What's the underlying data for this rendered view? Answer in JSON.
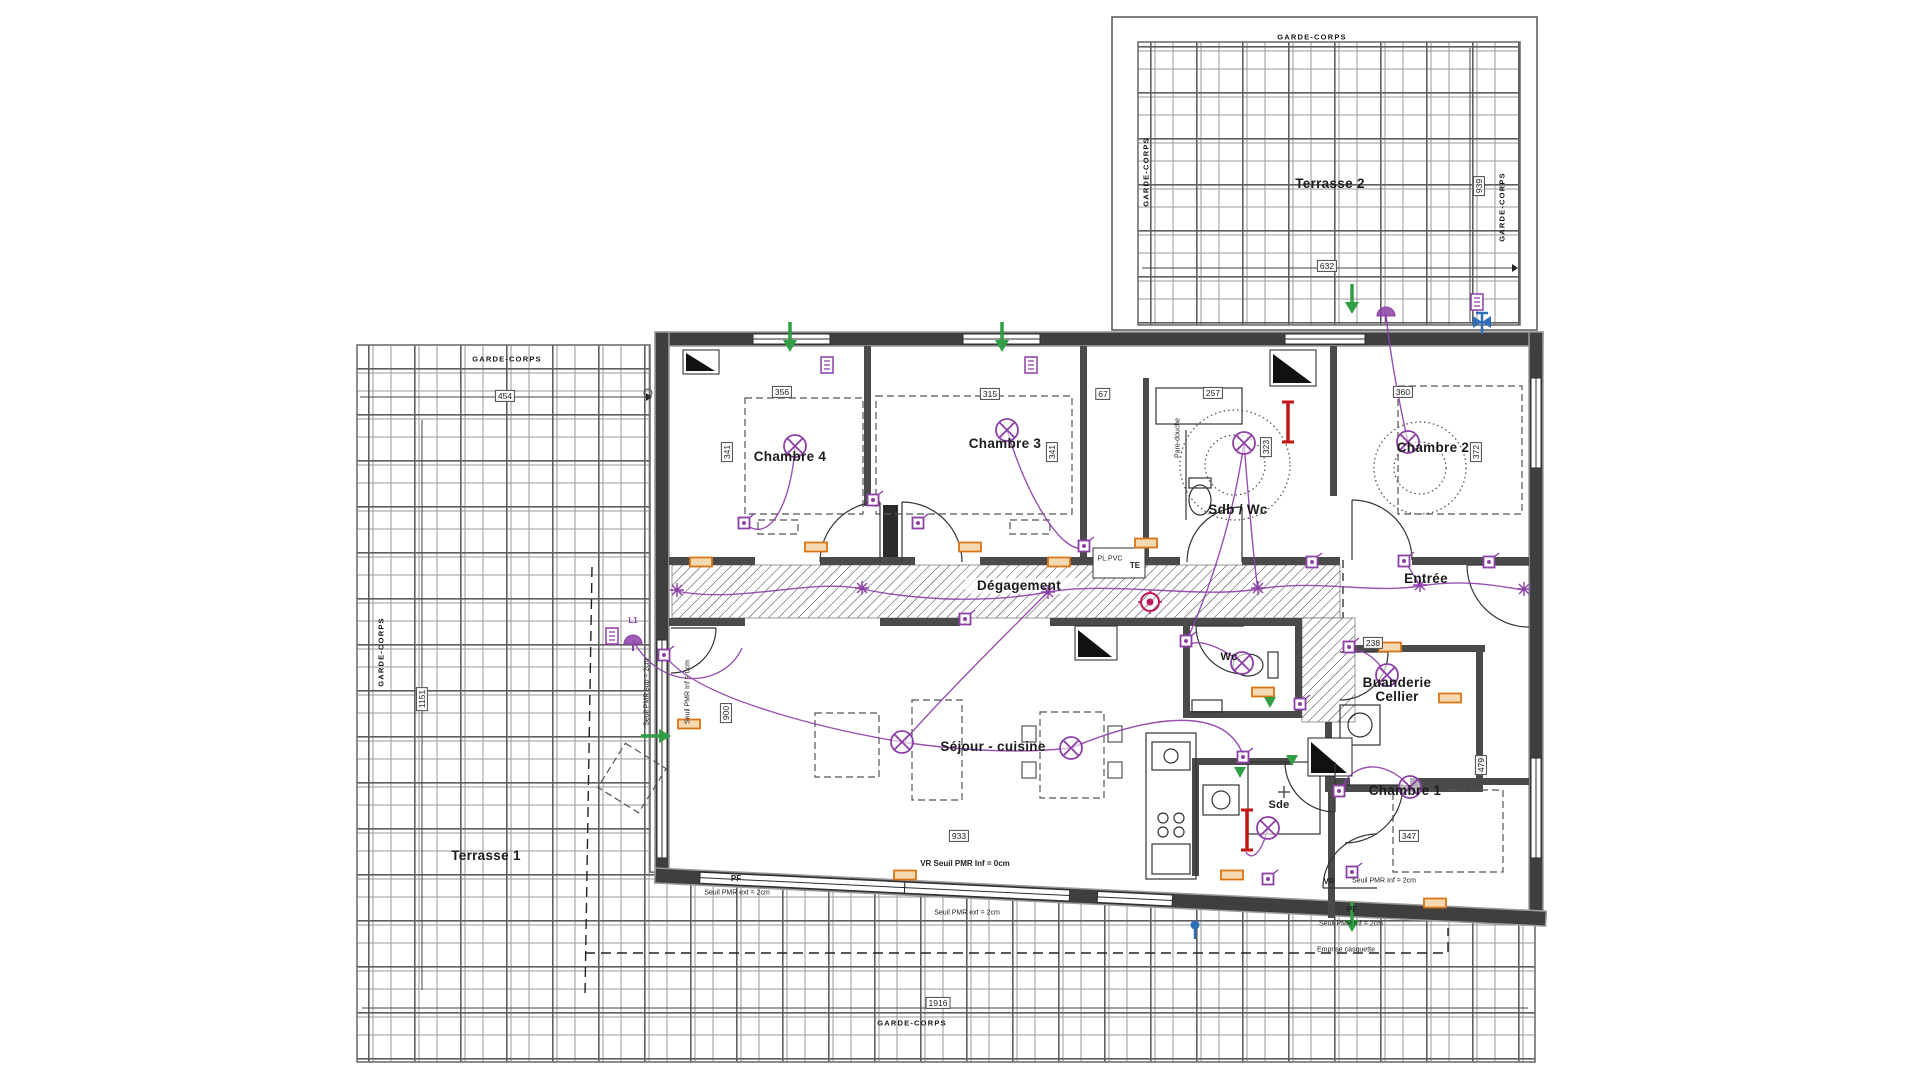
{
  "colors": {
    "wall": "#3f3f3f",
    "wall_outline": "#9c9c9c",
    "inner_wall": "#4a4a4a",
    "line": "#333333",
    "grid": "#8f8f8f",
    "grid_major": "#5f5f5f",
    "purple": "#8d3fa8",
    "orange": "#d97516",
    "orange_fill": "#f5d9b0",
    "green": "#2f9e44",
    "red": "#c11616",
    "blue": "#2f6fb8",
    "detector": "#c2185b"
  },
  "rooms": [
    {
      "name": "terrasse-2",
      "label": "Terrasse 2",
      "x": 1330,
      "y": 184,
      "cls": ""
    },
    {
      "name": "terrasse-1",
      "label": "Terrasse 1",
      "x": 486,
      "y": 856,
      "cls": ""
    },
    {
      "name": "chambre-4",
      "label": "Chambre 4",
      "x": 790,
      "y": 457,
      "cls": ""
    },
    {
      "name": "chambre-3",
      "label": "Chambre 3",
      "x": 1005,
      "y": 444,
      "cls": ""
    },
    {
      "name": "chambre-2",
      "label": "Chambre 2",
      "x": 1433,
      "y": 448,
      "cls": ""
    },
    {
      "name": "sdb-wc",
      "label": "Sdb / Wc",
      "x": 1238,
      "y": 510,
      "cls": ""
    },
    {
      "name": "degagement",
      "label": "Dégagement",
      "x": 1019,
      "y": 586,
      "cls": ""
    },
    {
      "name": "entree",
      "label": "Entrée",
      "x": 1426,
      "y": 579,
      "cls": ""
    },
    {
      "name": "wc",
      "label": "Wc",
      "x": 1229,
      "y": 658,
      "cls": "small"
    },
    {
      "name": "buanderie-cellier",
      "label": "Buanderie\nCellier",
      "x": 1397,
      "y": 690,
      "cls": ""
    },
    {
      "name": "sejour-cuisine",
      "label": "Séjour - cuisine",
      "x": 993,
      "y": 747,
      "cls": ""
    },
    {
      "name": "sde",
      "label": "Sde",
      "x": 1279,
      "y": 806,
      "cls": "small"
    },
    {
      "name": "chambre-1",
      "label": "Chambre 1",
      "x": 1405,
      "y": 791,
      "cls": ""
    }
  ],
  "dimensions": [
    {
      "text": "454",
      "x": 505,
      "y": 396,
      "v": false
    },
    {
      "text": "632",
      "x": 1327,
      "y": 266,
      "v": false
    },
    {
      "text": "939",
      "x": 1479,
      "y": 186,
      "v": true
    },
    {
      "text": "1151",
      "x": 422,
      "y": 699,
      "v": true
    },
    {
      "text": "1916",
      "x": 938,
      "y": 1003,
      "v": false
    },
    {
      "text": "356",
      "x": 782,
      "y": 392,
      "v": false
    },
    {
      "text": "315",
      "x": 990,
      "y": 394,
      "v": false
    },
    {
      "text": "67",
      "x": 1103,
      "y": 394,
      "v": false
    },
    {
      "text": "257",
      "x": 1213,
      "y": 393,
      "v": false
    },
    {
      "text": "360",
      "x": 1403,
      "y": 392,
      "v": false
    },
    {
      "text": "341",
      "x": 727,
      "y": 452,
      "v": true
    },
    {
      "text": "341",
      "x": 1052,
      "y": 452,
      "v": true
    },
    {
      "text": "323",
      "x": 1266,
      "y": 447,
      "v": true
    },
    {
      "text": "372",
      "x": 1476,
      "y": 452,
      "v": true
    },
    {
      "text": "238",
      "x": 1373,
      "y": 643,
      "v": false
    },
    {
      "text": "933",
      "x": 959,
      "y": 836,
      "v": false
    },
    {
      "text": "900",
      "x": 726,
      "y": 713,
      "v": true
    },
    {
      "text": "347",
      "x": 1409,
      "y": 836,
      "v": false
    },
    {
      "text": "479",
      "x": 1481,
      "y": 765,
      "v": true
    }
  ],
  "annotations": [
    {
      "text": "GARDE-CORPS",
      "x": 1312,
      "y": 37,
      "cls": "gc"
    },
    {
      "text": "GARDE-CORPS",
      "x": 1146,
      "y": 172,
      "cls": "gc v"
    },
    {
      "text": "GARDE-CORPS",
      "x": 1502,
      "y": 207,
      "cls": "gc v"
    },
    {
      "text": "GARDE-CORPS",
      "x": 507,
      "y": 359,
      "cls": "gc"
    },
    {
      "text": "GARDE-CORPS",
      "x": 381,
      "y": 652,
      "cls": "gc v"
    },
    {
      "text": "GARDE-CORPS",
      "x": 912,
      "y": 1023,
      "cls": "gc"
    },
    {
      "text": "Pare-douche",
      "x": 1178,
      "y": 438,
      "cls": "v"
    },
    {
      "text": "PL.PVC",
      "x": 1110,
      "y": 559,
      "cls": ""
    },
    {
      "text": "TE",
      "x": 1135,
      "y": 566,
      "cls": "bold"
    },
    {
      "text": "L1",
      "x": 633,
      "y": 621,
      "cls": "purple"
    },
    {
      "text": "Seuil PMR sup = 2cm",
      "x": 647,
      "y": 692,
      "cls": "v"
    },
    {
      "text": "Seuil PMR Inf = 0cm",
      "x": 688,
      "y": 692,
      "cls": "v"
    },
    {
      "text": "VR   Seuil PMR Inf = 0cm",
      "x": 965,
      "y": 864,
      "cls": "bold"
    },
    {
      "text": "PF",
      "x": 736,
      "y": 879,
      "cls": "bold"
    },
    {
      "text": "Seuil PMR ext = 2cm",
      "x": 737,
      "y": 893,
      "cls": ""
    },
    {
      "text": "Seuil PMR ext = 2cm",
      "x": 967,
      "y": 913,
      "cls": ""
    },
    {
      "text": "VR",
      "x": 1329,
      "y": 882,
      "cls": "bold"
    },
    {
      "text": "Seuil PMR Inf = 2cm",
      "x": 1384,
      "y": 881,
      "cls": ""
    },
    {
      "text": "PF",
      "x": 1352,
      "y": 910,
      "cls": "bold"
    },
    {
      "text": "Seuil PMR Inf = 2cm",
      "x": 1351,
      "y": 924,
      "cls": ""
    },
    {
      "text": "Emprise casquette",
      "x": 1346,
      "y": 950,
      "cls": ""
    }
  ],
  "symbols": {
    "ceiling_lights": [
      [
        795,
        446
      ],
      [
        1007,
        430
      ],
      [
        1244,
        443
      ],
      [
        1408,
        442
      ],
      [
        1242,
        663
      ],
      [
        1387,
        675
      ],
      [
        902,
        742
      ],
      [
        1071,
        748
      ],
      [
        1268,
        828
      ],
      [
        1410,
        787
      ]
    ],
    "wall_lights": [
      [
        633,
        640
      ],
      [
        1386,
        312
      ]
    ],
    "switches": [
      [
        744,
        523
      ],
      [
        918,
        523
      ],
      [
        1084,
        546
      ],
      [
        1186,
        641
      ],
      [
        1312,
        562
      ],
      [
        1349,
        647
      ],
      [
        1404,
        561
      ],
      [
        1339,
        791
      ],
      [
        1243,
        757
      ],
      [
        965,
        619
      ],
      [
        664,
        655
      ],
      [
        1489,
        562
      ],
      [
        1300,
        704
      ],
      [
        873,
        500
      ],
      [
        1268,
        879
      ],
      [
        1352,
        872
      ]
    ],
    "tags": [
      [
        827,
        365
      ],
      [
        1031,
        365
      ],
      [
        1477,
        302
      ],
      [
        612,
        636
      ]
    ],
    "sockets": [
      [
        816,
        547
      ],
      [
        970,
        547
      ],
      [
        701,
        562
      ],
      [
        1146,
        543
      ],
      [
        1059,
        562
      ],
      [
        1390,
        647
      ],
      [
        1263,
        692
      ],
      [
        1232,
        875
      ],
      [
        905,
        875
      ],
      [
        1450,
        698
      ],
      [
        689,
        724
      ],
      [
        1435,
        903
      ]
    ],
    "radiators": [
      [
        1288,
        422
      ],
      [
        1247,
        830
      ]
    ],
    "green_arrows": [
      [
        790,
        336,
        0
      ],
      [
        1002,
        336,
        0
      ],
      [
        1352,
        298,
        0
      ],
      [
        1352,
        916,
        0
      ],
      [
        655,
        736,
        -90
      ]
    ],
    "green_triangles": [
      [
        1270,
        702
      ],
      [
        1292,
        760
      ],
      [
        1240,
        772
      ]
    ],
    "detectors": [
      [
        1150,
        602
      ]
    ],
    "valves": [
      [
        1482,
        322
      ]
    ],
    "junctions": [
      [
        677,
        590
      ],
      [
        862,
        588
      ],
      [
        1048,
        592
      ],
      [
        1258,
        588
      ],
      [
        1420,
        585
      ],
      [
        1524,
        589
      ]
    ],
    "blue_pins": [
      [
        1195,
        925
      ]
    ]
  }
}
